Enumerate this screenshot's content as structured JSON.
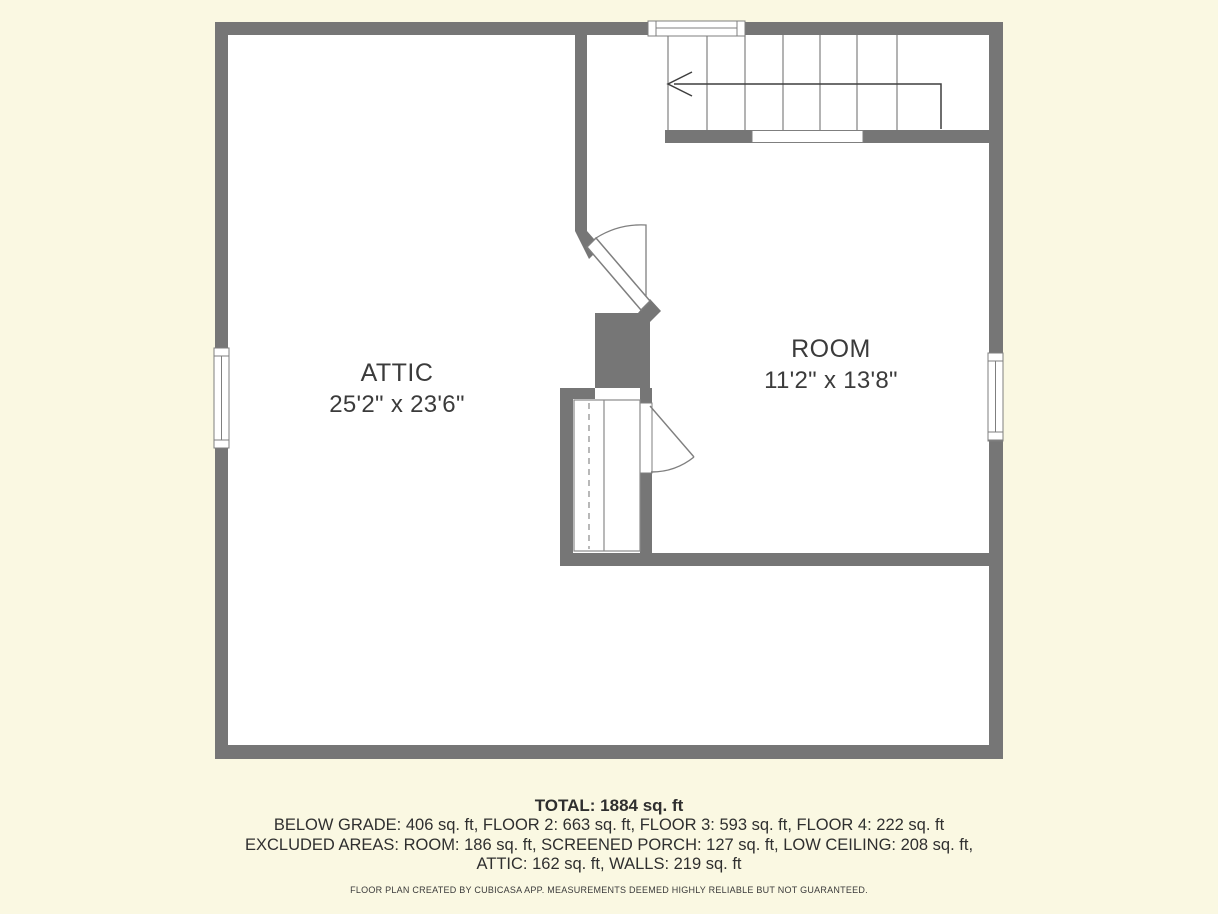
{
  "plan": {
    "rooms": [
      {
        "name": "ATTIC",
        "dimensions": "25'2\" x 23'6\""
      },
      {
        "name": "ROOM",
        "dimensions": "11'2\" x 13'8\""
      }
    ],
    "features": [
      "stairs-with-direction-arrow",
      "two-swing-doors",
      "closet-with-wardrobe",
      "three-windows"
    ]
  },
  "summary": {
    "total": "TOTAL: 1884 sq. ft",
    "line2": "BELOW GRADE: 406 sq. ft, FLOOR 2: 663 sq. ft, FLOOR 3: 593 sq. ft, FLOOR 4: 222 sq. ft",
    "line3": "EXCLUDED AREAS: ROOM: 186 sq. ft, SCREENED PORCH: 127 sq. ft, LOW CEILING: 208 sq. ft,",
    "line4": "ATTIC: 162 sq. ft, WALLS: 219 sq. ft"
  },
  "disclaimer": "FLOOR PLAN CREATED BY CUBICASA APP. MEASUREMENTS DEEMED HIGHLY RELIABLE BUT NOT GUARANTEED.",
  "colors": {
    "background": "#FAF8E2",
    "wall": "#767676",
    "floor": "#FFFFFF",
    "symbol_outline": "#7F7F7F",
    "stair_line": "#8A8A8A",
    "arrow": "#3F3F3F",
    "label_text": "#3B3B3B",
    "summary_text": "#2F2F2F"
  }
}
